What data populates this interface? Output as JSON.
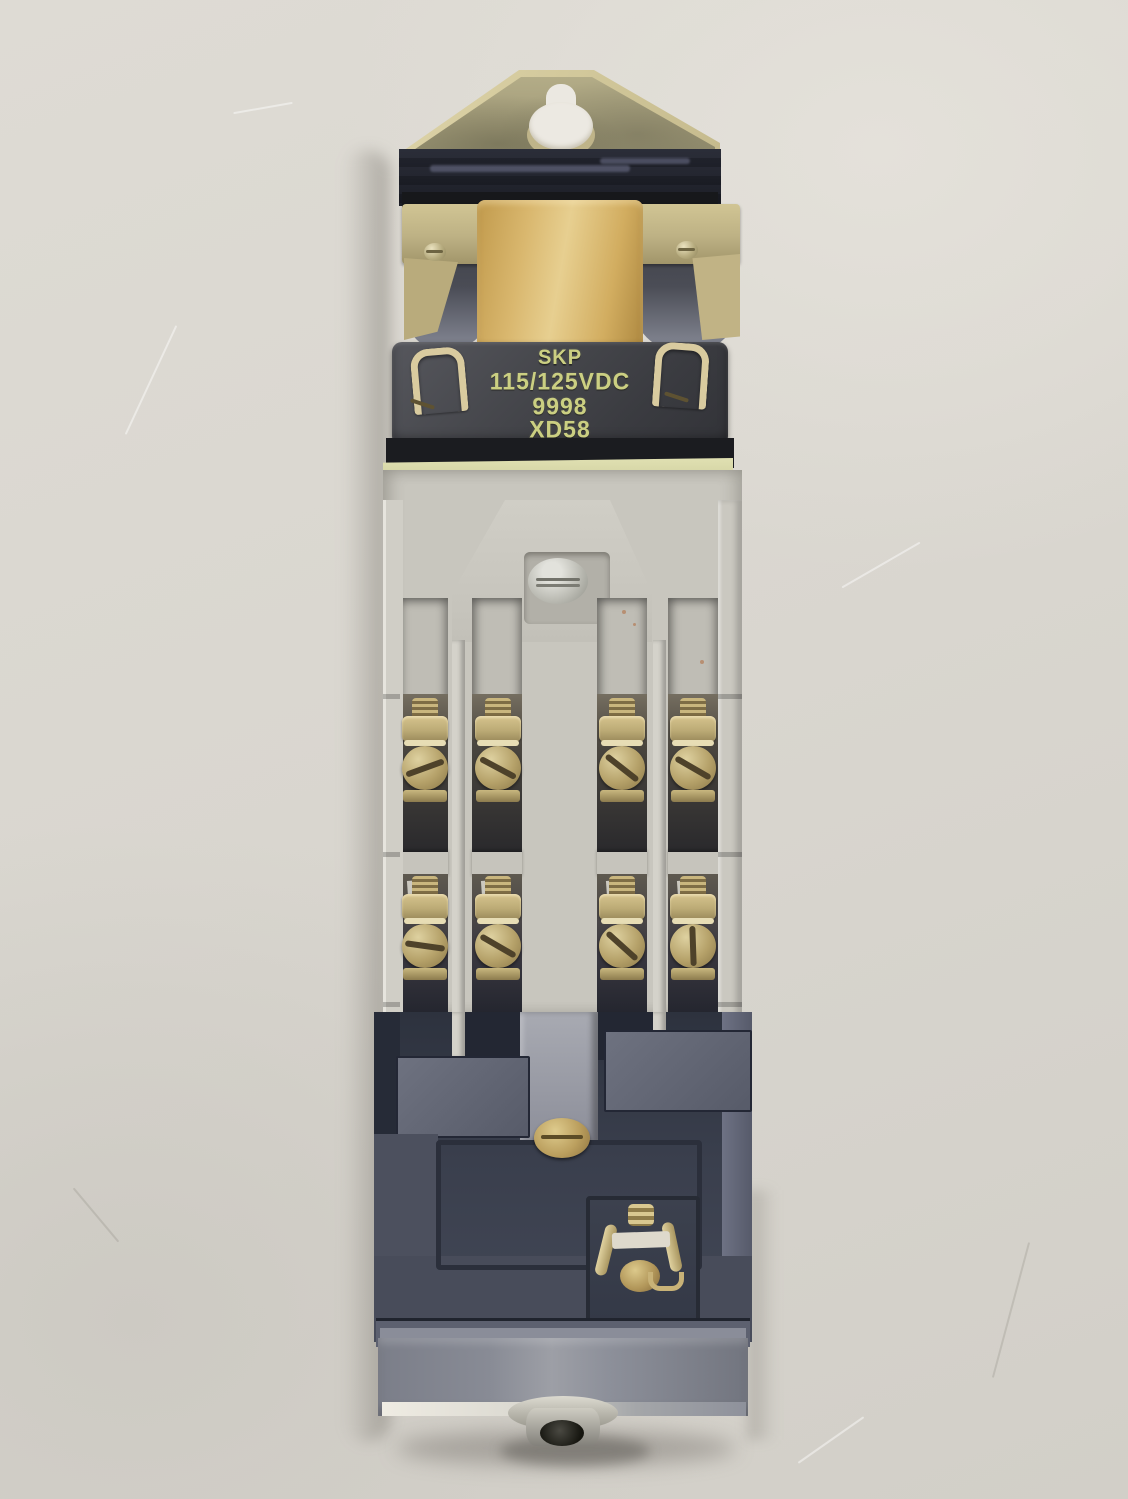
{
  "scene": {
    "description": "Product photograph of an industrial relay / contactor with DC coil, front view, on off-white paper background",
    "background_color": "#d9d6cf"
  },
  "coil_label": {
    "brand_line": "SKP",
    "voltage_line": "115/125VDC",
    "part_line": "9998",
    "code_line": "XD58",
    "text_color": "#cbcf82",
    "plate_color": "#45464b"
  },
  "colors": {
    "bracket_brass": "#d3c99c",
    "coil_wrap_gold": "#d9b76e",
    "terminal_brass": "#b5a169",
    "contact_block_gray": "#c8c6be",
    "lower_housing_navy": "#3a3f4d",
    "base_gray": "#888b95"
  }
}
